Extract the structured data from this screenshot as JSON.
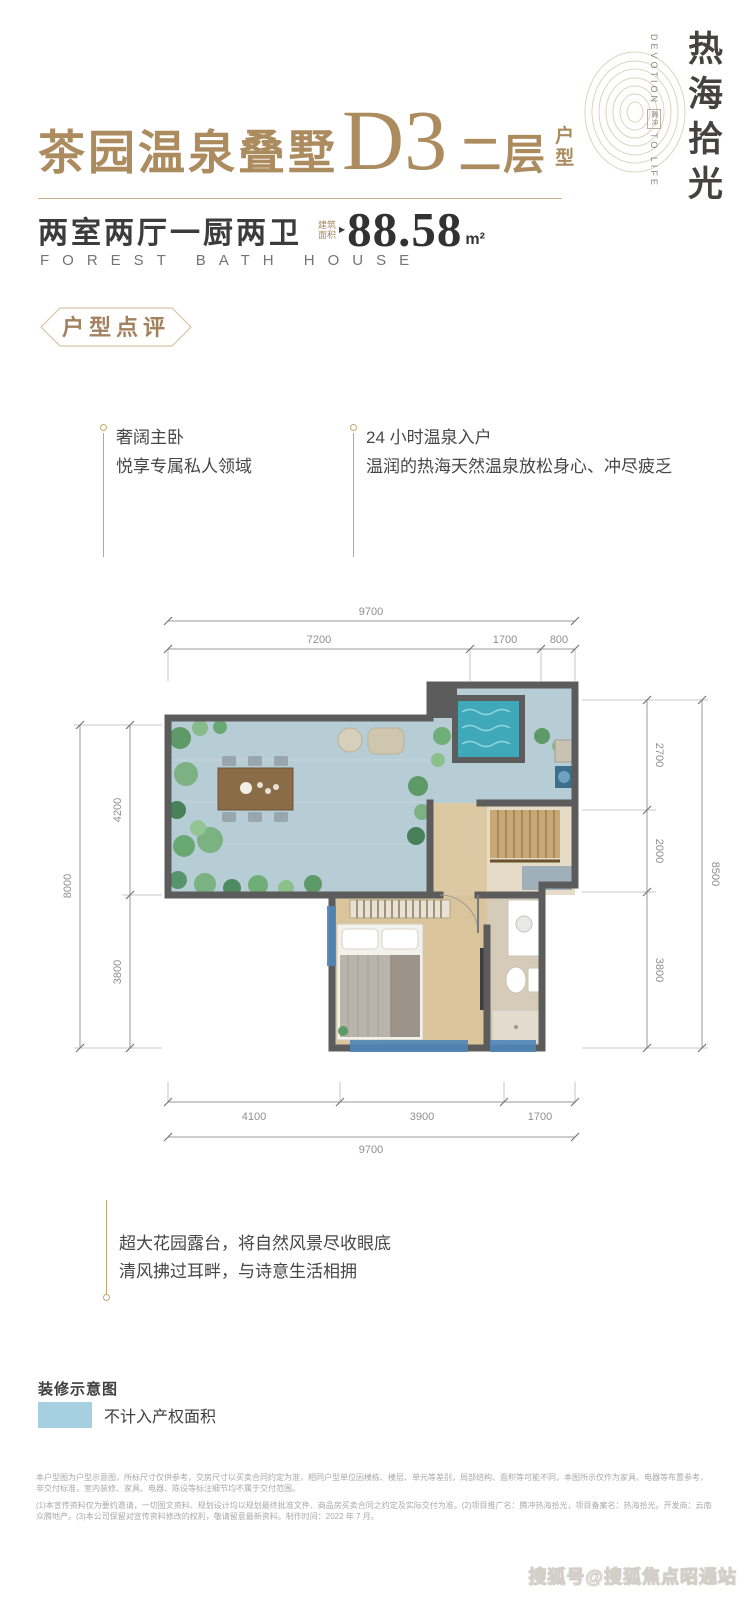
{
  "header": {
    "title": "茶园温泉叠墅",
    "unit": "D3",
    "floor": "二层",
    "floor_suffix": "户型",
    "rooms": "两室两厅一厨两卫",
    "area_label": "建筑面积",
    "area_value": "88.58",
    "area_unit": "m²",
    "english": "FOREST BATH HOUSE"
  },
  "logo": {
    "cn": "热海拾光",
    "en_top": "DEVOTION",
    "en_mid": "腾冲",
    "en_bottom": "TO LIFE"
  },
  "badge": {
    "label": "户型点评"
  },
  "callouts": [
    {
      "title": "奢阔主卧",
      "desc": "悦享专属私人领域"
    },
    {
      "title": "24 小时温泉入户",
      "desc": "温润的热海天然温泉放松身心、冲尽疲乏"
    }
  ],
  "floorplan": {
    "dims_top": {
      "total": "9700",
      "segments": [
        "7200",
        "1700",
        "800"
      ]
    },
    "dims_left": {
      "total": "8000",
      "segments": [
        "4200",
        "3800"
      ]
    },
    "dims_right": {
      "total": "8500",
      "segments": [
        "2700",
        "2000",
        "3800"
      ]
    },
    "dims_bottom": {
      "total": "9700",
      "segments": [
        "4100",
        "3900",
        "1700"
      ]
    }
  },
  "terrace_note": {
    "line1": "超大花园露台，将自然风景尽收眼底",
    "line2": "清风拂过耳畔，与诗意生活相拥"
  },
  "legend": {
    "title": "装修示意图",
    "item": "不计入产权面积"
  },
  "disclaimer": {
    "p1": "本户型图为户型示意图，所标尺寸仅供参考，交房尺寸以买卖合同约定为准，相同户型单位因楼栋、楼层、单元等差别，局部结构、面积等可能不同，本图所示仅作为家具、电器等布置参考，非交付标准，室内装修、家具、电器、陈设等标注细节均不属于交付范围。",
    "p2": "(1)本宣传资料仅为要约邀请，一切图文资料、规划设计均以规划最终批准文件、商品房买卖合同之约定及实际交付为准。(2)项目推广名：腾冲热海拾光，项目备案名：热海拾光。开发商：云南众腾地产。(3)本公司保留对宣传资料修改的权利，敬请留意最新资料。制作时间：2022 年 7 月。"
  },
  "watermark": "搜狐号@搜狐焦点昭通站",
  "colors": {
    "gold": "#ac8b5e",
    "dark_text": "#3c3c3c",
    "legend_blue": "#a6cfe2",
    "highlight_blue": "#4f86b8",
    "wall_gray": "#5d5c5c",
    "terrace_floor": "#b6cdd5",
    "wood_floor": "#d9c49c",
    "pool": "#3fa9ba"
  }
}
